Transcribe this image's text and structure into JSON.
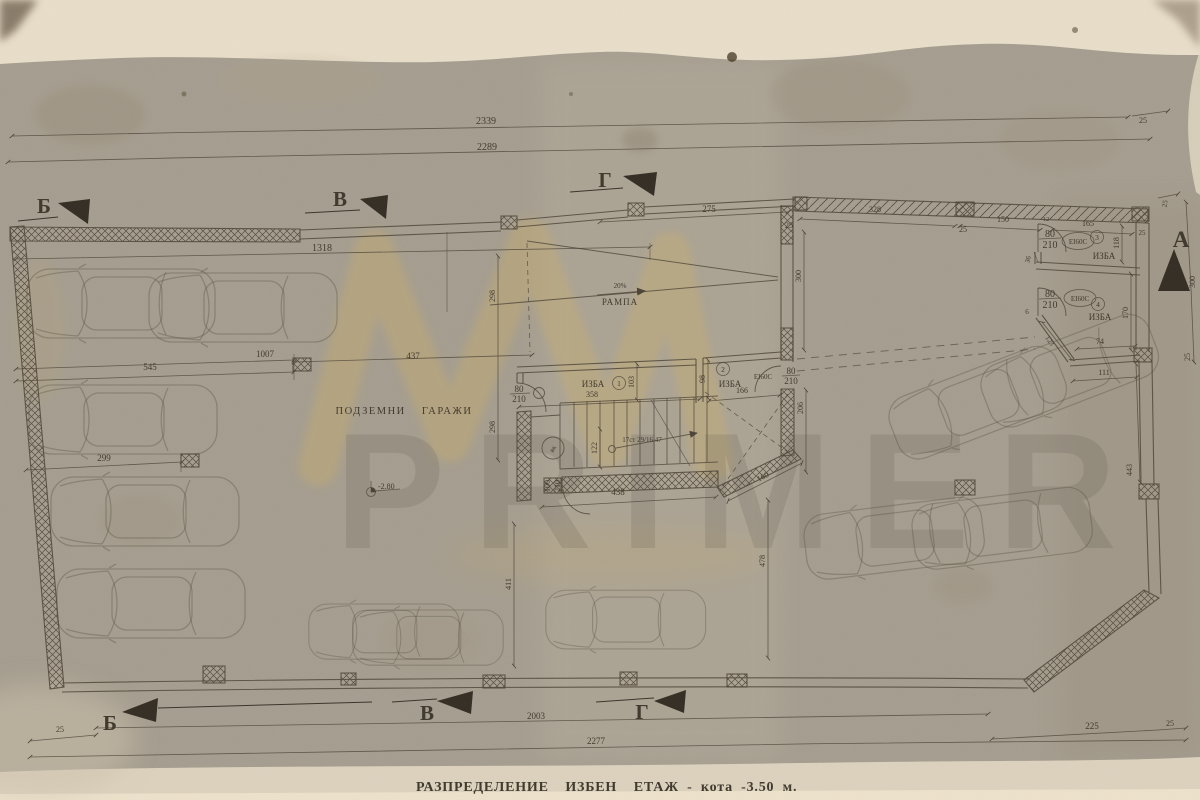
{
  "colors": {
    "paper": "#a69e90",
    "ink": "#4b4337",
    "watermark_yellow": "#d9b557"
  },
  "title": "РАЗПРЕДЕЛЕНИЕ  ИЗБЕН  ЕТАЖ - кота -3.50 м.",
  "watermark": "PRIMER",
  "sections": {
    "b_top": "Б",
    "v_top": "В",
    "g_top": "Г",
    "a_right": "А",
    "b_bottom": "Б",
    "v_bottom": "В",
    "g_bottom": "Г"
  },
  "labels": {
    "garages": "ПОДЗЕМНИ ГАРАЖИ",
    "ramp": "РАМПА",
    "slope": "20%",
    "stair_note": "17ст 29/16.47",
    "elevation": "-2.80",
    "shaft": "вк",
    "izba": "ИЗБА",
    "izba2": "ИЗБА",
    "izba3": "ИЗБА",
    "izba4": "ИЗБА",
    "no1": "1",
    "no2": "2",
    "no3": "3",
    "no4": "4",
    "fire_r2": "EI60C",
    "fire_r3": "EI60C",
    "fire_r4": "EI60C",
    "door_w1": "80",
    "door_h1": "210",
    "door_w2": "80",
    "door_h2": "210",
    "door_w3": "80",
    "door_h3": "210",
    "door_w4": "80",
    "door_h4": "210",
    "door_w5": "100",
    "door_h5": "210"
  },
  "dims": {
    "d2339": "2339",
    "d2289": "2289",
    "d25_top_right": "25",
    "d1318": "1318",
    "d1007": "1007",
    "d545": "545",
    "d437": "437",
    "d299": "299",
    "d298_a": "298",
    "d298_b": "298",
    "d411": "411",
    "d478": "478",
    "d275": "275",
    "d25_ramp": "25",
    "d300_ramp": "300",
    "d328": "328",
    "d25_wall": "25",
    "d150": "150",
    "d12": "12",
    "d165": "165",
    "d25_room3": "25",
    "d118": "118",
    "d170": "170",
    "d36": "36",
    "d6": "6",
    "d74": "74",
    "d123": "123",
    "d111": "111",
    "d443": "443",
    "d300_right": "300",
    "d25_right": "25",
    "d25_corner": "25",
    "d358": "358",
    "d103": "103",
    "d98": "98",
    "d166": "166",
    "d122": "122",
    "d438": "438",
    "d160": "160",
    "d206": "206",
    "d2003": "2003",
    "d2277": "2277",
    "d225": "225",
    "d25_bottom_right": "25",
    "d25_bottom_left": "25"
  }
}
